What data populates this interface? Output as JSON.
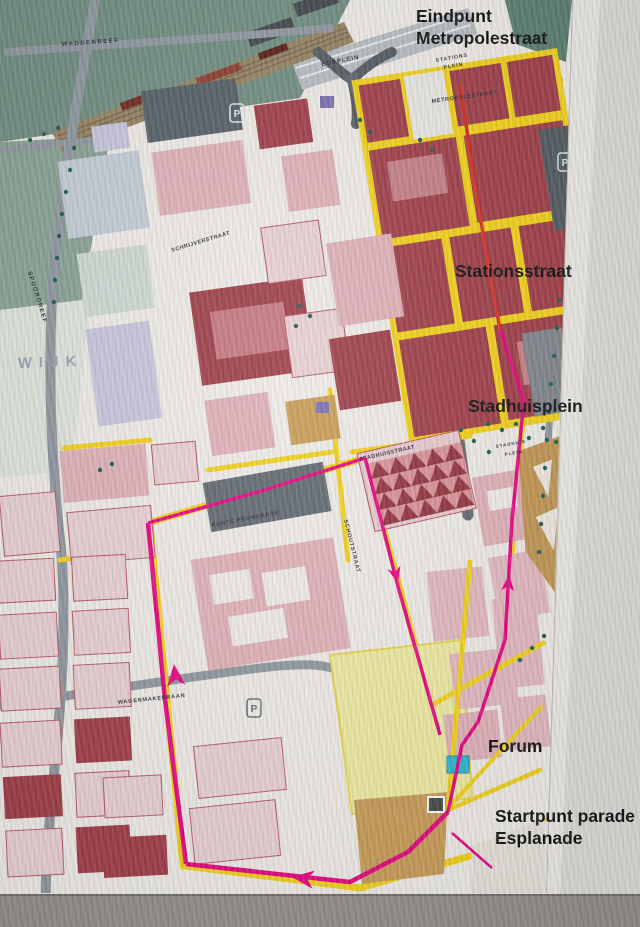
{
  "annotations": [
    {
      "id": "eindpunt-metropolestraat",
      "lines": [
        "Eindpunt",
        "Metropolestraat"
      ],
      "x": 416,
      "y": 22
    },
    {
      "id": "stationsstraat",
      "lines": [
        "Stationsstraat"
      ],
      "x": 455,
      "y": 277
    },
    {
      "id": "stadhuisplein",
      "lines": [
        "Stadhuisplein"
      ],
      "x": 468,
      "y": 412
    },
    {
      "id": "forum",
      "lines": [
        "Forum"
      ],
      "x": 488,
      "y": 752
    },
    {
      "id": "startpunt-esplanade",
      "lines": [
        "Startpunt parade",
        "Esplanade"
      ],
      "x": 495,
      "y": 822
    }
  ],
  "map_labels": [
    {
      "text": "WADDENREEF",
      "x": 62,
      "y": 46,
      "angle": -4,
      "size": 6,
      "spacing": 1.5
    },
    {
      "text": "BUSPLEIN",
      "x": 322,
      "y": 66,
      "angle": -11,
      "size": 6,
      "spacing": 1
    },
    {
      "text": "STATIONS",
      "x": 436,
      "y": 62,
      "angle": -10,
      "size": 5,
      "spacing": 1
    },
    {
      "text": "PLEIN",
      "x": 444,
      "y": 69,
      "angle": -10,
      "size": 5,
      "spacing": 1
    },
    {
      "text": "METROPOLESTRAAT",
      "x": 432,
      "y": 103,
      "angle": -8,
      "size": 5.5,
      "spacing": 0.6
    },
    {
      "text": "SCHRIJVERSTRAAT",
      "x": 172,
      "y": 252,
      "angle": -17,
      "size": 5.5,
      "spacing": 0.5
    },
    {
      "text": "SPOORDREEF",
      "x": 28,
      "y": 272,
      "angle": 73,
      "size": 6,
      "spacing": 1.2
    },
    {
      "text": "WIJK",
      "x": 18,
      "y": 368,
      "angle": -2,
      "size": 15,
      "spacing": 7,
      "color": "#97a3b2",
      "weight": "normal"
    },
    {
      "text": "STADHUISSTRAAT",
      "x": 360,
      "y": 461,
      "angle": -13,
      "size": 5.5,
      "spacing": 0.5
    },
    {
      "text": "STADHUIS",
      "x": 496,
      "y": 448,
      "angle": -10,
      "size": 4.5,
      "spacing": 1
    },
    {
      "text": "PLEIN",
      "x": 505,
      "y": 456,
      "angle": -10,
      "size": 4.5,
      "spacing": 1
    },
    {
      "text": "KORTE PROMENADE",
      "x": 212,
      "y": 527,
      "angle": -11,
      "size": 5.5,
      "spacing": 0.8
    },
    {
      "text": "SCHOUTSTRAAT",
      "x": 344,
      "y": 520,
      "angle": 76,
      "size": 5.5,
      "spacing": 0.8
    },
    {
      "text": "WAGENMAKERBAAN",
      "x": 118,
      "y": 704,
      "angle": -6,
      "size": 5.5,
      "spacing": 0.8
    }
  ],
  "route": {
    "colors": {
      "north": "#d42a20",
      "main": "#e6007e"
    },
    "segments": [
      {
        "id": "metropolestraat-leg",
        "color": "north",
        "width": 3.5,
        "points": [
          [
            460,
            84
          ],
          [
            478,
            205
          ],
          [
            500,
            330
          ]
        ]
      },
      {
        "id": "stationsstraat-leg",
        "color": "main",
        "width": 3.5,
        "points": [
          [
            500,
            330
          ],
          [
            524,
            400
          ],
          [
            512,
            520
          ],
          [
            505,
            640
          ]
        ]
      },
      {
        "id": "forum-leg",
        "color": "main",
        "width": 3.5,
        "points": [
          [
            505,
            640
          ],
          [
            478,
            722
          ],
          [
            462,
            745
          ],
          [
            448,
            812
          ]
        ]
      },
      {
        "id": "bottom-leg",
        "color": "main",
        "width": 4.5,
        "points": [
          [
            448,
            812
          ],
          [
            408,
            852
          ],
          [
            350,
            882
          ],
          [
            186,
            864
          ]
        ]
      },
      {
        "id": "west-leg",
        "color": "main",
        "width": 4.5,
        "points": [
          [
            186,
            864
          ],
          [
            165,
            700
          ],
          [
            148,
            523
          ]
        ]
      },
      {
        "id": "promenade-leg",
        "color": "main",
        "width": 3.5,
        "points": [
          [
            148,
            523
          ],
          [
            258,
            492
          ],
          [
            365,
            458
          ]
        ]
      },
      {
        "id": "schoutstraat-leg",
        "color": "main",
        "width": 3.5,
        "points": [
          [
            365,
            458
          ],
          [
            399,
            590
          ],
          [
            440,
            735
          ]
        ]
      },
      {
        "id": "start-tail",
        "color": "main",
        "width": 2.5,
        "points": [
          [
            452,
            833
          ],
          [
            492,
            868
          ]
        ]
      }
    ],
    "arrows": [
      {
        "x": 509,
        "y": 575,
        "angle": -85,
        "size": 16
      },
      {
        "x": 292,
        "y": 877,
        "angle": 187,
        "size": 22
      },
      {
        "x": 174,
        "y": 664,
        "angle": -96,
        "size": 22
      },
      {
        "x": 398,
        "y": 583,
        "angle": 75,
        "size": 16
      }
    ]
  },
  "parking": {
    "glyph": "P",
    "positions": [
      {
        "x": 237,
        "y": 113,
        "variant": "dark"
      },
      {
        "x": 565,
        "y": 162,
        "variant": "dark"
      },
      {
        "x": 254,
        "y": 708,
        "variant": "light"
      }
    ]
  },
  "colors": {
    "route_main": "#e6007e",
    "route_north": "#d42a20",
    "street_yellow": "#f2d116",
    "block_dark_red": "#9d3a44",
    "block_pink": "#dfb0b6",
    "block_light_pink": "#e9d0d3",
    "park_green": "#6d8b7e",
    "road_gray": "#8d969d",
    "water_cyan": "#2ab5d2"
  }
}
